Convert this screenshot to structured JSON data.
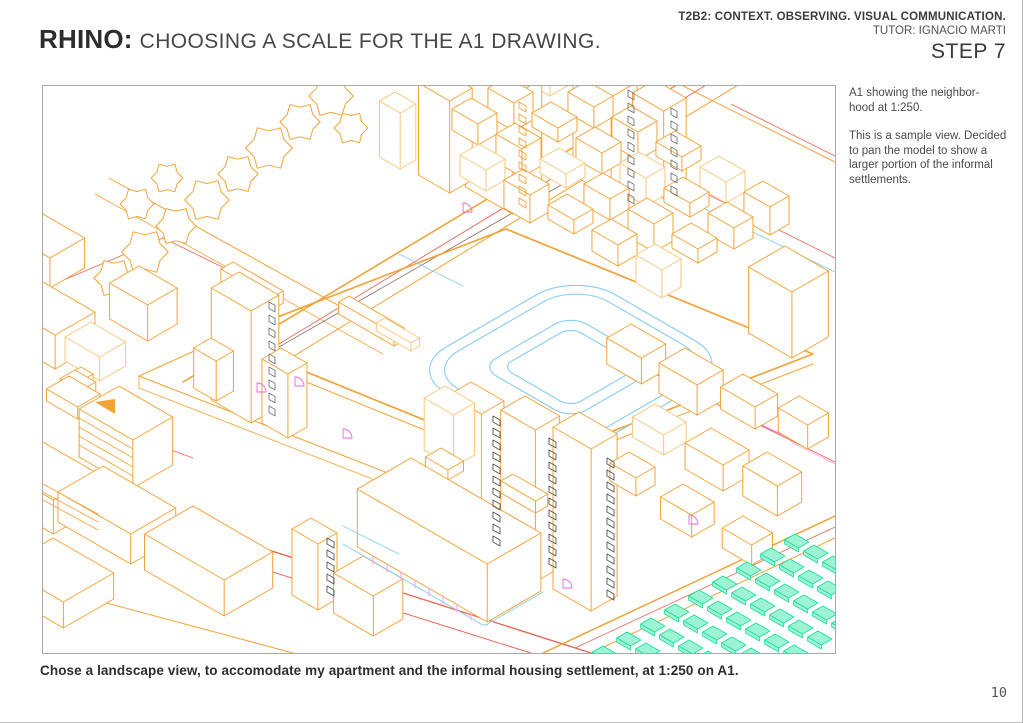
{
  "header": {
    "title_bold": "RHINO:",
    "title_rest": "CHOOSING A SCALE FOR THE A1 DRAWING.",
    "course": "T2B2: CONTEXT. OBSERVING. VISUAL COMMUNICATION.",
    "tutor": "TUTOR: IGNACIO MARTI",
    "step": "STEP 7"
  },
  "figure": {
    "description": "Rhino perspective wireframe view of the neighborhood model",
    "note_para1": "A1 showing the neighbor-\nhood at 1:250.",
    "note_para2": "This is a sample view. Decided\nto pan the model to show a\nlarger portion of the informal\nsettlements."
  },
  "caption": "Chose a landscape view, to accomodate my apartment and the informal housing settlement, at 1:250 on A1.",
  "page_number": "10",
  "palette": {
    "orange": "#f2a338",
    "orange_light": "#f8c87d",
    "red": "#e86753",
    "street_dark": "#8a6f68",
    "magenta": "#ef63e2",
    "pink": "#f9a8ef",
    "cyan": "#89cdf0",
    "green": "#1bdf9b",
    "green_fill": "#9df4d4",
    "gray_window": "#777777",
    "gray_dark": "#555555"
  }
}
